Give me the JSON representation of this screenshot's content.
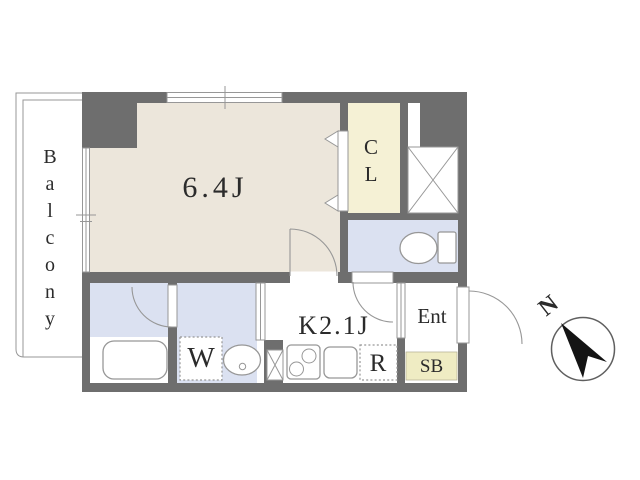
{
  "floorplan": {
    "labels": {
      "balcony": "Balcony",
      "main_room": "6.4J",
      "closet": "CL",
      "kitchen": "K2.1J",
      "washing_machine": "W",
      "refrigerator": "R",
      "entrance": "Ent",
      "shoe_box": "SB"
    },
    "compass": {
      "north": "N"
    },
    "colors": {
      "wall": "#6e6e6e",
      "floor_main": "#ece6db",
      "floor_closet": "#f5f1d5",
      "floor_wet": "#dbe1f1",
      "floor_shoebox": "#efecc3",
      "line": "#979797",
      "text": "#2b2b2b",
      "arrow": "#141414"
    }
  }
}
